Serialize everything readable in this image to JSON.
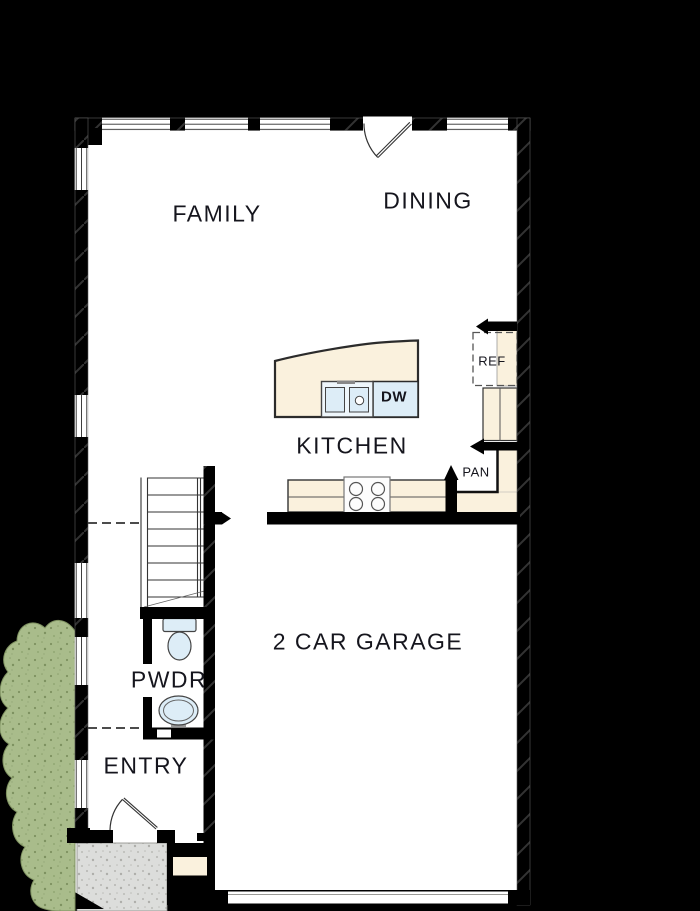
{
  "plan": {
    "floor_labels": {
      "family": "FAMILY",
      "dining": "DINING",
      "kitchen": "KITCHEN",
      "garage": "2 CAR GARAGE",
      "powder": "PWDR",
      "entry": "ENTRY"
    },
    "fixture_labels": {
      "refrigerator": "REF",
      "dishwasher": "DW",
      "pantry": "PAN"
    },
    "colors": {
      "background": "#000000",
      "floor": "#ffffff",
      "walls": "#000000",
      "counters": "#faf1dd",
      "fixtures_blue": "#ddedf7",
      "landscaping": "#a9bc8b",
      "porch": "#dcdddb",
      "text": "#15151d"
    }
  }
}
